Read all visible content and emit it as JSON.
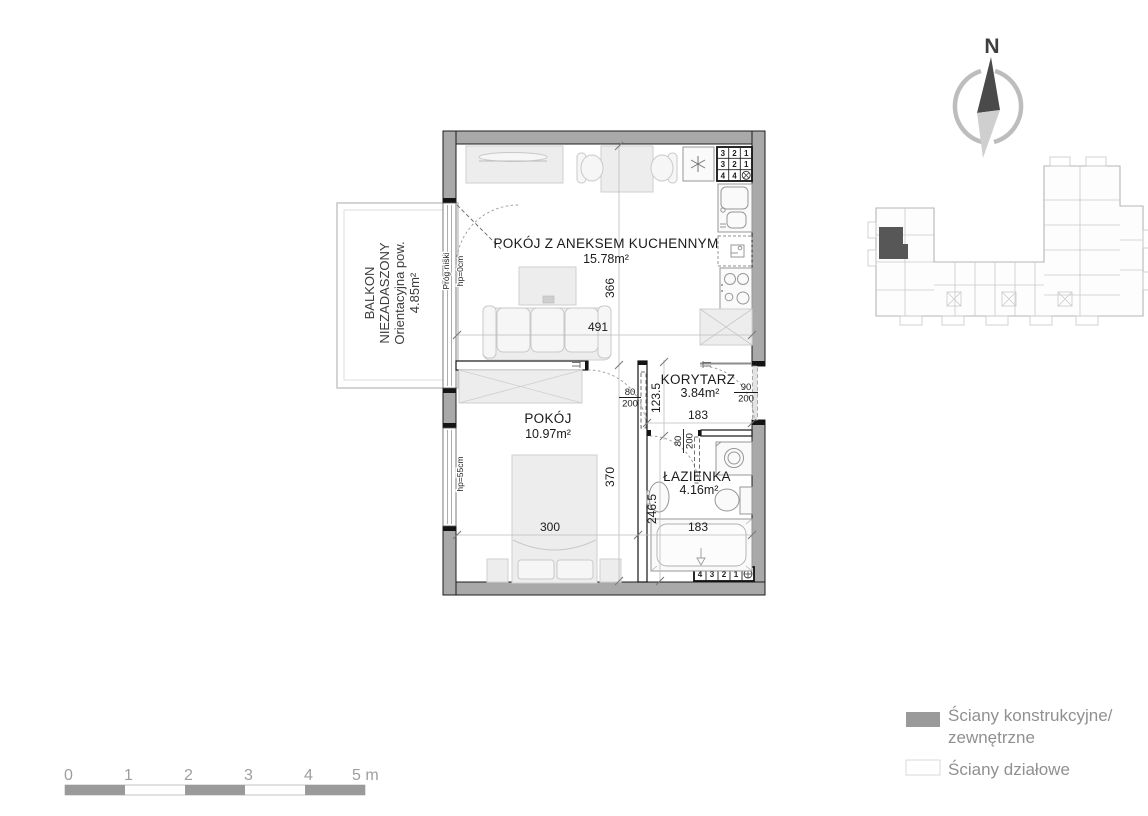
{
  "plan": {
    "rooms": [
      {
        "name": "POKÓJ Z ANEKSEM KUCHENNYM",
        "area": "15.78m²"
      },
      {
        "name": "POKÓJ",
        "area": "10.97m²"
      },
      {
        "name": "KORYTARZ",
        "area": "3.84m²"
      },
      {
        "name": "ŁAZIENKA",
        "area": "4.16m²"
      }
    ],
    "balcony": {
      "lines": [
        "BALKON",
        "NIEZADASZONY",
        "Orientacyjna pow.",
        "4.85m²"
      ]
    },
    "dims": {
      "living_height": "366",
      "living_width": "491",
      "bedroom_height": "370",
      "bedroom_width": "300",
      "corridor_height": "123.5",
      "corridor_width": "183",
      "bathroom_height": "246.5",
      "bathroom_width": "183"
    },
    "doors": {
      "bedroom_w": "80",
      "bedroom_h": "200",
      "entrance_w": "90",
      "entrance_h": "200",
      "bathroom_w": "80",
      "bathroom_h": "200"
    },
    "windows": {
      "balcony_threshold": "Próg niski",
      "balcony_sill": "hp=0cm",
      "bedroom_sill": "hp=55cm"
    },
    "meter_grid": {
      "rows": [
        [
          "3",
          "2",
          "1"
        ],
        [
          "3",
          "2",
          "1"
        ],
        [
          "4",
          "4"
        ]
      ]
    },
    "meter_strip": {
      "cells": [
        "4",
        "3",
        "2",
        "1"
      ]
    }
  },
  "compass": {
    "north": "N"
  },
  "legend": {
    "items": [
      {
        "line1": "Ściany konstrukcyjne/",
        "line2": "zewnętrzne",
        "swatch_color": "#9a9a9a"
      },
      {
        "label": "Ściany działowe",
        "swatch_color": "#ffffff"
      }
    ]
  },
  "scalebar": {
    "labels": [
      "0",
      "1",
      "2",
      "3",
      "4",
      "5 m"
    ],
    "segment_color": "#9a9a9a"
  },
  "colors": {
    "exterior_wall": "#a9a9a9",
    "highlight_unit": "#575757",
    "legend_text": "#909090"
  }
}
